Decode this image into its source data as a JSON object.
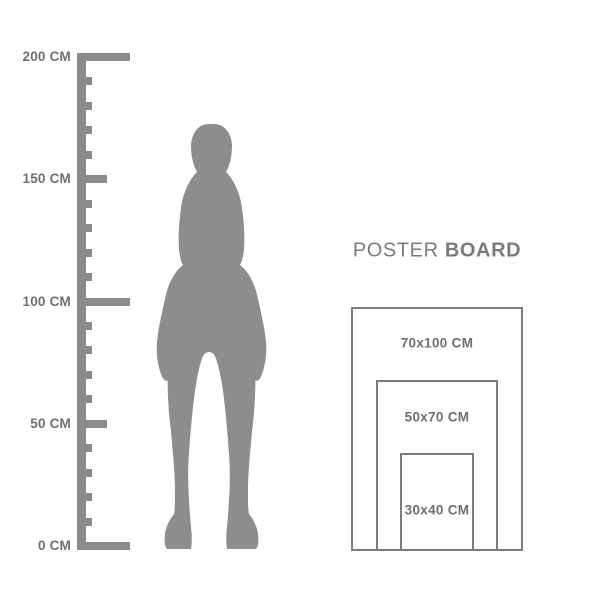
{
  "colors": {
    "background": "#ffffff",
    "ruler": "#8b8b8b",
    "silhouette": "#8d8d8d",
    "label_text": "#6f6f6f",
    "poster_border": "#7c7c7c",
    "title_text": "#7b7b7b"
  },
  "ruler": {
    "unit": "CM",
    "min_cm": 0,
    "max_cm": 200,
    "step_cm": 10,
    "long_ticks_cm": [
      0,
      100,
      200
    ],
    "medium_ticks_cm": [
      50,
      150
    ],
    "labels": [
      {
        "cm": 200,
        "text": "200 CM"
      },
      {
        "cm": 150,
        "text": "150 CM"
      },
      {
        "cm": 100,
        "text": "100 CM"
      },
      {
        "cm": 50,
        "text": "50 CM"
      },
      {
        "cm": 0,
        "text": "0 CM"
      }
    ]
  },
  "figure": {
    "description": "standing woman silhouette"
  },
  "poster": {
    "title_regular": "POSTER",
    "title_bold": "BOARD",
    "sizes": [
      {
        "label": "70x100 CM",
        "width_cm": 70,
        "height_cm": 100
      },
      {
        "label": "50x70 CM",
        "width_cm": 50,
        "height_cm": 70
      },
      {
        "label": "30x40 CM",
        "width_cm": 30,
        "height_cm": 40
      }
    ]
  }
}
